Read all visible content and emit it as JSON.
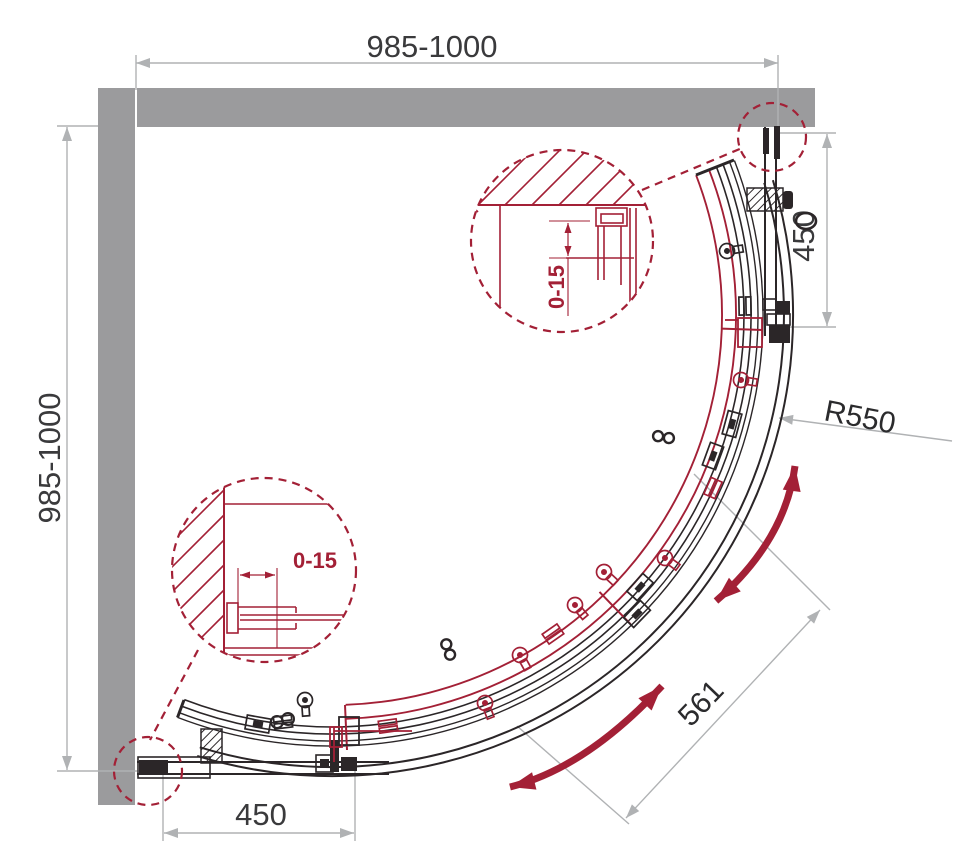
{
  "drawing": {
    "dim_top_width": "985-1000",
    "dim_left_height": "985-1000",
    "dim_right_panel": "450",
    "dim_bottom_panel": "450",
    "dim_radius": "R550",
    "dim_diagonal_opening": "561",
    "dim_detail_top_adjust": "0-15",
    "dim_detail_bottom_adjust": "0-15"
  },
  "colors": {
    "accent_red": "#a32036",
    "wall_gray": "#9b9b9d",
    "dim_gray": "#b0b2b4",
    "label_dark": "#3a3a3c",
    "line_black": "#2b2628"
  }
}
